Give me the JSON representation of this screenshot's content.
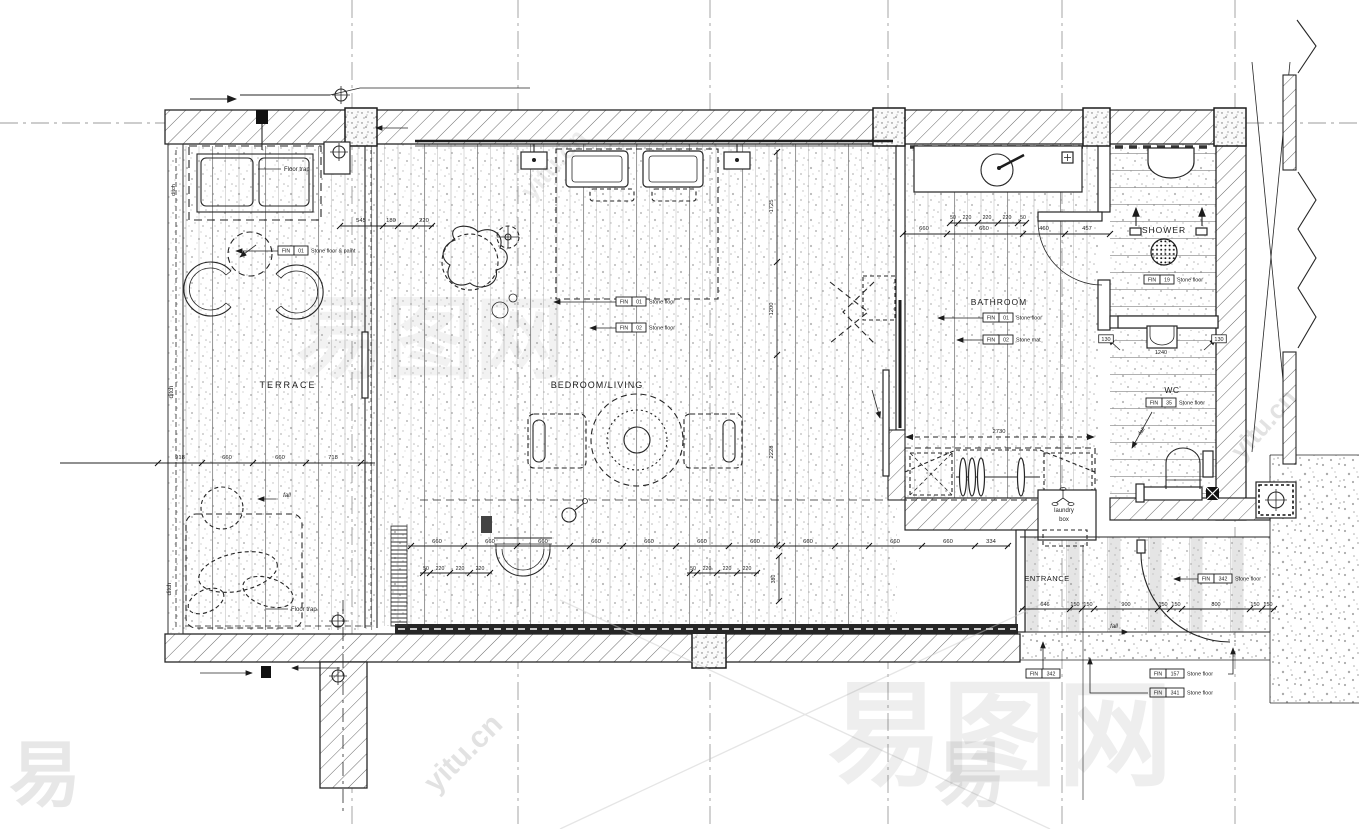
{
  "drawing": {
    "title": "Villa guest-room floor plan",
    "colors": {
      "ink": "#1c1c1c",
      "paper": "#ffffff",
      "hatch": "#6a6a6a",
      "plank": "#9b9b9b",
      "stipple": "#8a8a8a",
      "watermark": "#777777"
    },
    "labels": [
      {
        "t": "TERRACE",
        "x": 288,
        "y": 388,
        "fs": 9,
        "ls": 2
      },
      {
        "t": "BEDROOM/LIVING",
        "x": 597,
        "y": 388,
        "fs": 9,
        "ls": 1
      },
      {
        "t": "BATHROOM",
        "x": 999,
        "y": 305,
        "fs": 8.5,
        "ls": 1
      },
      {
        "t": "SHOWER",
        "x": 1164,
        "y": 233,
        "fs": 8.5,
        "ls": 1
      },
      {
        "t": "WC",
        "x": 1172,
        "y": 393,
        "fs": 8.5,
        "ls": 0.5
      },
      {
        "t": "ENTRANCE",
        "x": 1047,
        "y": 581,
        "fs": 7.5,
        "ls": 0.5
      },
      {
        "t": "laundry",
        "x": 1064,
        "y": 512,
        "fs": 6
      },
      {
        "t": "box",
        "x": 1064,
        "y": 521,
        "fs": 6
      },
      {
        "t": "Floor trap",
        "x": 284,
        "y": 171,
        "fs": 6,
        "anchor": "start"
      },
      {
        "t": "Floor trap",
        "x": 291,
        "y": 611,
        "fs": 6,
        "anchor": "start"
      },
      {
        "t": "ditch",
        "x": 173,
        "y": 392,
        "fs": 6,
        "rot": -90
      },
      {
        "t": "ditch",
        "x": 171,
        "y": 589,
        "fs": 6,
        "rot": -90
      },
      {
        "t": "ditch",
        "x": 175,
        "y": 190,
        "fs": 5.5,
        "rot": -90
      },
      {
        "t": "fall",
        "x": 287,
        "y": 497,
        "fs": 6,
        "it": 1
      },
      {
        "t": "fall",
        "x": 1114,
        "y": 628,
        "fs": 6,
        "it": 1
      },
      {
        "t": "fall",
        "x": 1143,
        "y": 432,
        "fs": 5.5,
        "it": 1,
        "rot": -55
      },
      {
        "t": "1240",
        "x": 1161,
        "y": 354,
        "fs": 5.5
      },
      {
        "t": "130",
        "x": 1106,
        "y": 341,
        "fs": 5.5,
        "box": 1
      },
      {
        "t": "130",
        "x": 1219,
        "y": 341,
        "fs": 5.5,
        "box": 1
      }
    ],
    "dim_chains": [
      {
        "pts": [
          60,
          463,
          375,
          463
        ],
        "ticks": [
          [
            158,
            463
          ],
          [
            202,
            463
          ],
          [
            253,
            463
          ],
          [
            306,
            463
          ],
          [
            361,
            463
          ]
        ],
        "labels": [
          {
            "t": "918",
            "x": 180,
            "y": 459
          },
          {
            "t": "660",
            "x": 227,
            "y": 459
          },
          {
            "t": "660",
            "x": 280,
            "y": 459
          },
          {
            "t": "718",
            "x": 333,
            "y": 459
          }
        ]
      },
      {
        "pts": [
          340,
          226,
          434,
          226
        ],
        "ticks": [
          [
            340,
            226
          ],
          [
            383,
            226
          ],
          [
            398,
            226
          ],
          [
            415,
            226
          ],
          [
            432,
            226
          ]
        ],
        "labels": [
          {
            "t": "545",
            "x": 361,
            "y": 222
          },
          {
            "t": "180",
            "x": 391,
            "y": 222
          },
          {
            "t": "220",
            "x": 424,
            "y": 222
          }
        ]
      },
      {
        "pts": [
          903,
          234,
          1110,
          234
        ],
        "ticks": [
          [
            903,
            234
          ],
          [
            947,
            234
          ],
          [
            1023,
            234
          ],
          [
            1065,
            234
          ],
          [
            1110,
            234
          ]
        ],
        "labels": [
          {
            "t": "660",
            "x": 924,
            "y": 230
          },
          {
            "t": "660",
            "x": 984,
            "y": 230
          },
          {
            "t": "460",
            "x": 1044,
            "y": 230
          },
          {
            "t": "457",
            "x": 1087,
            "y": 230
          }
        ]
      },
      {
        "pts": [
          950,
          223,
          1026,
          223
        ],
        "fs": 5.2,
        "ticks": [
          [
            950,
            223
          ],
          [
            958,
            223
          ],
          [
            978,
            223
          ],
          [
            998,
            223
          ],
          [
            1018,
            223
          ],
          [
            1026,
            223
          ]
        ],
        "labels": [
          {
            "t": "50",
            "x": 953,
            "y": 219
          },
          {
            "t": "220",
            "x": 967,
            "y": 219
          },
          {
            "t": "220",
            "x": 987,
            "y": 219
          },
          {
            "t": "220",
            "x": 1007,
            "y": 219
          },
          {
            "t": "50",
            "x": 1023,
            "y": 219
          }
        ]
      },
      {
        "pts": [
          408,
          546,
          1010,
          546
        ],
        "ticks": [
          [
            411,
            546
          ],
          [
            464,
            546
          ],
          [
            517,
            546
          ],
          [
            570,
            546
          ],
          [
            623,
            546
          ],
          [
            676,
            546
          ],
          [
            729,
            546
          ],
          [
            782,
            546
          ],
          [
            835,
            546
          ],
          [
            869,
            546
          ],
          [
            922,
            546
          ],
          [
            975,
            546
          ],
          [
            1008,
            546
          ]
        ],
        "labels": [
          {
            "t": "660",
            "x": 437,
            "y": 543
          },
          {
            "t": "660",
            "x": 490,
            "y": 543
          },
          {
            "t": "660",
            "x": 543,
            "y": 543
          },
          {
            "t": "660",
            "x": 596,
            "y": 543
          },
          {
            "t": "660",
            "x": 649,
            "y": 543
          },
          {
            "t": "660",
            "x": 702,
            "y": 543
          },
          {
            "t": "660",
            "x": 755,
            "y": 543
          },
          {
            "t": "660",
            "x": 808,
            "y": 543
          },
          {
            "t": "660",
            "x": 895,
            "y": 543
          },
          {
            "t": "660",
            "x": 948,
            "y": 543
          },
          {
            "t": "334",
            "x": 991,
            "y": 543
          }
        ]
      },
      {
        "pts": [
          420,
          573,
          492,
          573
        ],
        "fs": 5.2,
        "ticks": [
          [
            423,
            573
          ],
          [
            430,
            573
          ],
          [
            450,
            573
          ],
          [
            470,
            573
          ],
          [
            490,
            573
          ]
        ],
        "labels": [
          {
            "t": "50",
            "x": 426,
            "y": 570
          },
          {
            "t": "220",
            "x": 440,
            "y": 570
          },
          {
            "t": "220",
            "x": 460,
            "y": 570
          },
          {
            "t": "220",
            "x": 480,
            "y": 570
          }
        ]
      },
      {
        "pts": [
          687,
          573,
          759,
          573
        ],
        "fs": 5.2,
        "ticks": [
          [
            690,
            573
          ],
          [
            697,
            573
          ],
          [
            717,
            573
          ],
          [
            737,
            573
          ],
          [
            757,
            573
          ]
        ],
        "labels": [
          {
            "t": "50",
            "x": 693,
            "y": 570
          },
          {
            "t": "220",
            "x": 707,
            "y": 570
          },
          {
            "t": "220",
            "x": 727,
            "y": 570
          },
          {
            "t": "220",
            "x": 747,
            "y": 570
          }
        ]
      },
      {
        "pts": [
          777,
          150,
          777,
          548
        ],
        "ticks": [
          [
            777,
            152
          ],
          [
            777,
            262
          ],
          [
            777,
            355
          ],
          [
            777,
            545
          ]
        ],
        "labels": [
          {
            "t": "1725",
            "x": 773,
            "y": 206,
            "rot": -90
          },
          {
            "t": "1200",
            "x": 773,
            "y": 309,
            "rot": -90
          },
          {
            "t": "2228",
            "x": 773,
            "y": 452,
            "rot": -90
          }
        ]
      },
      {
        "pts": [
          779,
          556,
          779,
          601
        ],
        "fs": 5.2,
        "ticks": [
          [
            779,
            556
          ],
          [
            779,
            601
          ]
        ],
        "labels": [
          {
            "t": "380",
            "x": 775,
            "y": 579,
            "rot": -90
          }
        ]
      },
      {
        "pts": [
          1020,
          609,
          1276,
          609
        ],
        "fs": 5.5,
        "ticks": [
          [
            1022,
            609
          ],
          [
            1070,
            609
          ],
          [
            1082,
            609
          ],
          [
            1094,
            609
          ],
          [
            1158,
            609
          ],
          [
            1170,
            609
          ],
          [
            1182,
            609
          ],
          [
            1250,
            609
          ],
          [
            1262,
            609
          ],
          [
            1274,
            609
          ]
        ],
        "labels": [
          {
            "t": "646",
            "x": 1045,
            "y": 606
          },
          {
            "t": "150",
            "x": 1075,
            "y": 606
          },
          {
            "t": "150",
            "x": 1088,
            "y": 606
          },
          {
            "t": "900",
            "x": 1126,
            "y": 606
          },
          {
            "t": "150",
            "x": 1163,
            "y": 606
          },
          {
            "t": "150",
            "x": 1176,
            "y": 606
          },
          {
            "t": "800",
            "x": 1216,
            "y": 606
          },
          {
            "t": "150",
            "x": 1255,
            "y": 606
          },
          {
            "t": "150",
            "x": 1268,
            "y": 606
          }
        ]
      },
      {
        "pts": [
          906,
          437,
          1094,
          437
        ],
        "dash": 1,
        "arrows": 1,
        "labels": [
          {
            "t": "2730",
            "x": 999,
            "y": 433
          }
        ]
      }
    ],
    "fin_tags": [
      {
        "x": 278,
        "y": 246,
        "num": "01",
        "desc": "Stone floor & paint",
        "lead": [
          [
            278,
            251
          ],
          [
            236,
            251
          ]
        ]
      },
      {
        "x": 616,
        "y": 297,
        "num": "01",
        "desc": "Stone floor",
        "lead": [
          [
            616,
            302
          ],
          [
            554,
            302
          ]
        ]
      },
      {
        "x": 616,
        "y": 323,
        "num": "02",
        "desc": "Stone floor",
        "lead": [
          [
            616,
            328
          ],
          [
            590,
            328
          ]
        ]
      },
      {
        "x": 983,
        "y": 313,
        "num": "01",
        "desc": "Stone floor",
        "lead": [
          [
            983,
            318
          ],
          [
            938,
            318
          ]
        ]
      },
      {
        "x": 983,
        "y": 335,
        "num": "02",
        "desc": "Stone mat",
        "lead": [
          [
            983,
            340
          ],
          [
            957,
            340
          ]
        ]
      },
      {
        "x": 1144,
        "y": 275,
        "num": "19",
        "desc": "Stone floor"
      },
      {
        "x": 1146,
        "y": 398,
        "num": "35",
        "desc": "Stone floor"
      },
      {
        "x": 1198,
        "y": 574,
        "num": "342",
        "desc": "Stone floor",
        "lead": [
          [
            1198,
            579
          ],
          [
            1174,
            579
          ]
        ]
      },
      {
        "x": 1026,
        "y": 669,
        "num": "342",
        "desc": "",
        "lead": [
          [
            1043,
            669
          ],
          [
            1043,
            642
          ]
        ]
      },
      {
        "x": 1150,
        "y": 669,
        "num": "157",
        "desc": "Stone floor",
        "lead": [
          [
            1228,
            674
          ],
          [
            1233,
            674
          ],
          [
            1233,
            648
          ]
        ]
      },
      {
        "x": 1150,
        "y": 688,
        "num": "341",
        "desc": "Stone floor",
        "lead": [
          [
            1148,
            693
          ],
          [
            1090,
            693
          ],
          [
            1090,
            658
          ]
        ]
      }
    ],
    "watermarks": [
      {
        "t": "易图网",
        "x": 1000,
        "y": 775,
        "fs": 115,
        "op": 0.07
      },
      {
        "t": "易图网",
        "x": 430,
        "y": 370,
        "fs": 90,
        "op": 0.05
      },
      {
        "t": "易",
        "x": 45,
        "y": 800,
        "fs": 72,
        "op": 0.1
      },
      {
        "t": "易",
        "x": 970,
        "y": 800,
        "fs": 72,
        "op": 0.09
      },
      {
        "t": "yitu.cn",
        "x": 470,
        "y": 760,
        "fs": 30,
        "rot": -45,
        "op": 0.12
      },
      {
        "t": "yitu.cn",
        "x": 1270,
        "y": 430,
        "fs": 26,
        "rot": -48,
        "op": 0.12
      },
      {
        "t": "yitu.cn",
        "x": 560,
        "y": 170,
        "fs": 26,
        "rot": -48,
        "op": 0.08
      }
    ]
  }
}
